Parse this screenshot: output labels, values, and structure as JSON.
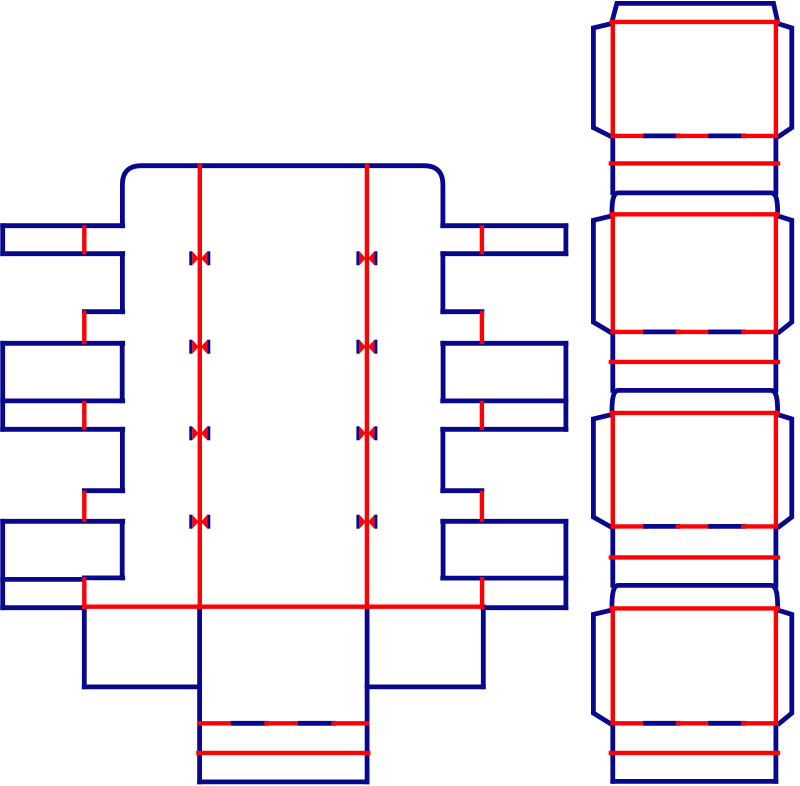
{
  "canvas": {
    "width": 800,
    "height": 786,
    "background": "#ffffff"
  },
  "styles": {
    "cut_color": "#08088e",
    "crease_color": "#f90306",
    "cut_stroke_width": 4.8,
    "crease_stroke_width": 4.4,
    "nick_half_height": 7,
    "nick_bar_width": 3,
    "nick_outer_offset": 10.5,
    "nick_tip_offset": 1.2
  },
  "pieces": [
    {
      "id": "tray-blank",
      "cut_paths": [
        "M 122.4 225.7 L 122.4 184.7 Q 122.4 165.7 141.4 165.7 L 423.9 165.7 Q 442.9 165.7 442.9 184.7 L 442.9 225.7"
      ],
      "cut_lines": [
        [
          2.7,
          225.7,
          122.7,
          225.7
        ],
        [
          2.7,
          225.7,
          2.7,
          253.7
        ],
        [
          2.7,
          253.7,
          122.7,
          253.7
        ],
        [
          122.4,
          253.7,
          122.4,
          311.7
        ],
        [
          84.3,
          311.7,
          122.7,
          311.7
        ],
        [
          2.7,
          343.3,
          122.7,
          343.3
        ],
        [
          2.7,
          343.3,
          2.7,
          429.3
        ],
        [
          122.2,
          343.3,
          122.2,
          400.9
        ],
        [
          2.7,
          400.9,
          122.7,
          400.9
        ],
        [
          2.7,
          429.3,
          122.7,
          429.3
        ],
        [
          122.4,
          429.3,
          122.4,
          490.7
        ],
        [
          84.3,
          490.7,
          122.7,
          490.7
        ],
        [
          2.7,
          521.3,
          122.7,
          521.3
        ],
        [
          2.7,
          521.3,
          2.7,
          607.7
        ],
        [
          122.2,
          521.3,
          122.2,
          577.9
        ],
        [
          84.3,
          577.9,
          122.7,
          577.9
        ],
        [
          2.7,
          579.4,
          83.3,
          579.4
        ],
        [
          2.7,
          607.7,
          83.3,
          607.7
        ],
        [
          442.7,
          225.7,
          565.9,
          225.7
        ],
        [
          565.9,
          225.7,
          565.9,
          253.7
        ],
        [
          442.7,
          253.7,
          565.9,
          253.7
        ],
        [
          442.9,
          253.7,
          442.9,
          311.7
        ],
        [
          442.7,
          311.7,
          481.9,
          311.7
        ],
        [
          442.7,
          343.3,
          565.9,
          343.3
        ],
        [
          565.9,
          343.3,
          565.9,
          429.3
        ],
        [
          443.1,
          343.3,
          443.1,
          400.9
        ],
        [
          442.7,
          400.9,
          565.9,
          400.9
        ],
        [
          442.7,
          429.3,
          565.9,
          429.3
        ],
        [
          442.9,
          429.3,
          442.9,
          490.7
        ],
        [
          442.7,
          490.7,
          481.9,
          490.7
        ],
        [
          442.7,
          521.3,
          565.9,
          521.3
        ],
        [
          565.9,
          521.3,
          565.9,
          607.7
        ],
        [
          443.1,
          521.3,
          443.1,
          577.9
        ],
        [
          442.7,
          578.1,
          565.9,
          578.1
        ],
        [
          485.3,
          607.7,
          565.9,
          607.7
        ],
        [
          84.3,
          606.9,
          84.3,
          686.9
        ],
        [
          84.3,
          686.9,
          199.6,
          686.9
        ],
        [
          483.3,
          606.9,
          483.3,
          686.9
        ],
        [
          367.1,
          686.9,
          483.3,
          686.9
        ],
        [
          199.6,
          606.7,
          199.6,
          781.9
        ],
        [
          367.1,
          606.7,
          367.1,
          781.9
        ],
        [
          199.6,
          781.9,
          367.1,
          781.9
        ]
      ],
      "crease_lines": [
        [
          199.8,
          166.2,
          199.8,
          606.7
        ],
        [
          366.9,
          166.2,
          366.9,
          606.7
        ],
        [
          84.3,
          227.4,
          84.3,
          252.0
        ],
        [
          84.3,
          312.9,
          84.3,
          341.9
        ],
        [
          84.3,
          402.9,
          84.3,
          427.6
        ],
        [
          84.3,
          492.9,
          84.3,
          519.6
        ],
        [
          84.3,
          579.4,
          84.3,
          606.4
        ],
        [
          481.9,
          227.4,
          481.9,
          252.0
        ],
        [
          481.9,
          312.9,
          481.9,
          341.9
        ],
        [
          481.9,
          402.9,
          481.9,
          427.6
        ],
        [
          481.9,
          492.9,
          481.9,
          519.6
        ],
        [
          482.1,
          579.4,
          482.1,
          607.4
        ],
        [
          84.3,
          606.7,
          481.9,
          606.7
        ],
        [
          198.4,
          752.9,
          368.3,
          752.9
        ]
      ],
      "cut_crease_lines": [
        {
          "y": 723.3,
          "x1": 199.6,
          "x2": 367.1,
          "segments": 5
        }
      ],
      "nicks": {
        "xs": [
          199.8,
          366.9
        ],
        "ys": [
          258.3,
          346.7,
          433.3,
          521.7
        ]
      }
    },
    {
      "id": "sleeve-blank",
      "cut_paths": [
        "M 611.9 21.9 L 616.9 3.4 L 773.5 3.4 L 777.7 21.9",
        "M 611.9 23.5 L 593.4 27.9 L 593.4 127.7 L 609.9 135.9",
        "M 777.7 23.5 L 791.8 27.9 L 791.8 127.7 L 779.5 135.9",
        "M 611.9 215.9 L 593.4 220.3 L 593.4 322.1 L 609.9 331.9",
        "M 777.7 215.9 L 791.8 220.3 L 791.8 322.1 L 779.5 331.9",
        "M 611.9 414.5 L 593.4 418.9 L 593.4 517.1 L 609.9 526.4",
        "M 777.7 414.5 L 791.8 418.9 L 791.8 517.1 L 779.5 526.4",
        "M 611.9 610.0 L 593.4 614.4 L 593.4 713.1 L 609.9 723.3",
        "M 777.7 610.0 L 791.8 614.4 L 791.8 713.1 L 779.5 723.3",
        "M 611.9 214.3 C 611.9 201 613.0 192.9 618.4 192.9 L 770.9 192.9 C 776.6 192.9 777.7 201 777.7 214.3",
        "M 611.9 412.9 C 611.9 399.5 613.0 390.4 618.4 390.4 L 770.9 390.4 C 776.6 390.4 777.7 399.5 777.7 412.9",
        "M 611.9 608.4 C 611.9 595.0 613.0 585.4 618.4 585.4 L 770.9 585.4 C 776.6 585.4 777.7 595.0 777.7 608.4"
      ],
      "cut_lines": [
        [
          612.8,
          137.4,
          612.8,
          192.9
        ],
        [
          775.9,
          137.4,
          775.9,
          192.9
        ],
        [
          612.8,
          333.4,
          612.8,
          390.4
        ],
        [
          775.9,
          333.4,
          775.9,
          390.4
        ],
        [
          612.8,
          527.9,
          612.8,
          585.4
        ],
        [
          775.9,
          527.9,
          775.9,
          585.4
        ],
        [
          612.8,
          723.9,
          612.8,
          781.4
        ],
        [
          775.9,
          723.9,
          775.9,
          781.4
        ],
        [
          612.8,
          781.4,
          775.9,
          781.4
        ]
      ],
      "crease_lines": [
        [
          611.9,
          21.9,
          777.7,
          21.9
        ],
        [
          611.9,
          214.3,
          777.7,
          214.3
        ],
        [
          611.9,
          412.9,
          777.7,
          412.9
        ],
        [
          611.9,
          608.4,
          777.7,
          608.4
        ],
        [
          612.8,
          21.9,
          612.8,
          135.9
        ],
        [
          775.9,
          21.9,
          775.9,
          135.9
        ],
        [
          612.8,
          214.3,
          612.8,
          331.9
        ],
        [
          775.9,
          214.3,
          775.9,
          331.9
        ],
        [
          612.8,
          412.9,
          612.8,
          526.4
        ],
        [
          775.9,
          412.9,
          775.9,
          526.4
        ],
        [
          612.8,
          608.4,
          612.8,
          723.3
        ],
        [
          775.9,
          608.4,
          775.9,
          723.3
        ],
        [
          610.9,
          163.4,
          777.9,
          163.4
        ],
        [
          610.9,
          361.9,
          777.9,
          361.9
        ],
        [
          610.9,
          557.4,
          777.9,
          557.4
        ],
        [
          610.9,
          752.9,
          777.9,
          752.9
        ]
      ],
      "cut_crease_lines": [
        {
          "y": 135.9,
          "x1": 612.8,
          "x2": 775.9,
          "segments": 5
        },
        {
          "y": 331.9,
          "x1": 612.8,
          "x2": 775.9,
          "segments": 5
        },
        {
          "y": 526.4,
          "x1": 612.8,
          "x2": 775.9,
          "segments": 5
        },
        {
          "y": 723.3,
          "x1": 612.8,
          "x2": 775.9,
          "segments": 5
        }
      ],
      "nicks": {
        "xs": [],
        "ys": []
      }
    }
  ]
}
